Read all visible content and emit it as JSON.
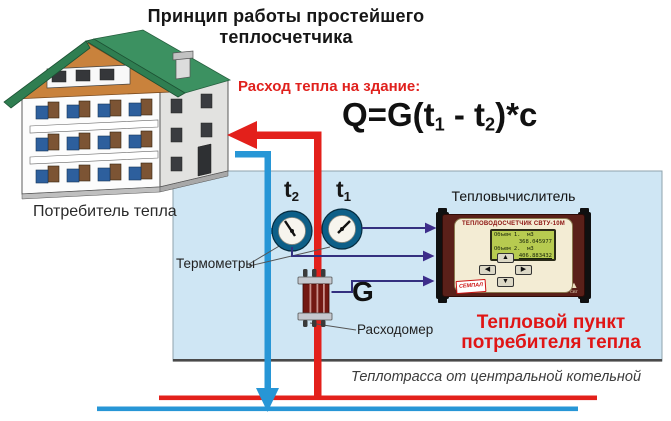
{
  "title": "Принцип работы простейшего теплосчетчика",
  "formula": {
    "heading": "Расход тепла на здание:",
    "p1": "Q=G(t",
    "s1": "1",
    "p2": " - t",
    "s2": "2",
    "p3": ")*c"
  },
  "house": {
    "label": "Потребитель тепла"
  },
  "sensors": {
    "t2": {
      "base": "t",
      "sub": "2"
    },
    "t1": {
      "base": "t",
      "sub": "1"
    },
    "thermometers_label": "Термометры",
    "flow_symbol": "G",
    "flowmeter_label": "Расходомер"
  },
  "calculator": {
    "label": "Тепловычислитель",
    "model": "ТЕПЛОВОДОСЧЕТЧИК СВТУ-10М",
    "lcd": [
      "Объем 1.  м3",
      "368.045977",
      "Объем 2.  м3",
      "406.883432"
    ],
    "buttons": {
      "up": "▲",
      "left": "◀",
      "right": "▶",
      "down": "▼"
    },
    "brand": "СЕМПАЛ",
    "badge_icon": "▲",
    "badge": "СВТ"
  },
  "heat_point": {
    "line1": "Тепловой пункт",
    "line2": "потребителя тепла"
  },
  "main_line_label": "Теплотрасса от центральной котельной",
  "colors": {
    "pipe_hot": "#e3201b",
    "pipe_cold": "#2796d6",
    "box_bg": "#cfe6f4",
    "accent_red": "#e01515",
    "signal_line": "#34307f",
    "roof_green": "#2f7e51",
    "gable_orange": "#c9823c",
    "device_maroon": "#5a2019",
    "lcd_green": "#b7cb50"
  }
}
